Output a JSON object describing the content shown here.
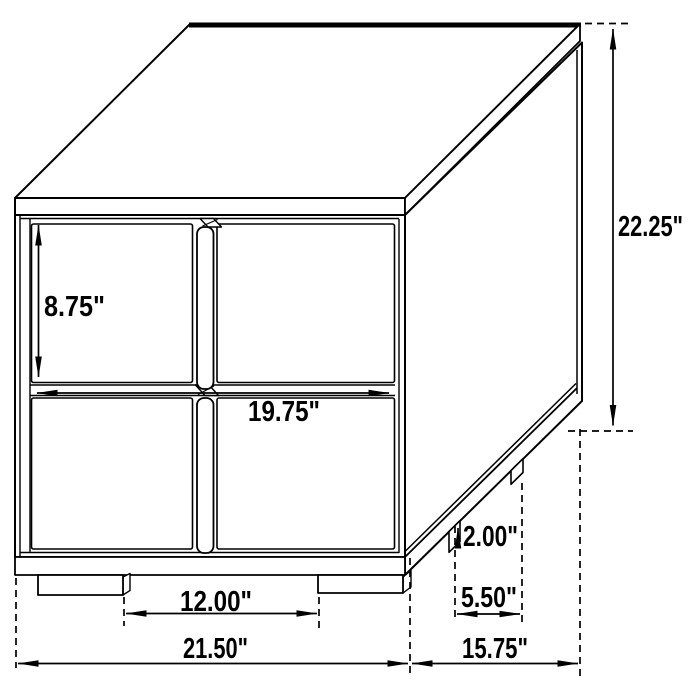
{
  "diagram": {
    "kind": "furniture-dimension-drawing",
    "colors": {
      "line": "#000000",
      "background": "#ffffff",
      "text": "#000000"
    },
    "dimensions": {
      "drawer_height": "8.75\"",
      "drawer_width": "19.75\"",
      "overall_height": "22.25\"",
      "leg_height": "2.00\"",
      "side_leg_spacing": "5.50\"",
      "front_leg_spacing": "12.00\"",
      "overall_width": "21.50\"",
      "overall_depth": "15.75\""
    }
  }
}
